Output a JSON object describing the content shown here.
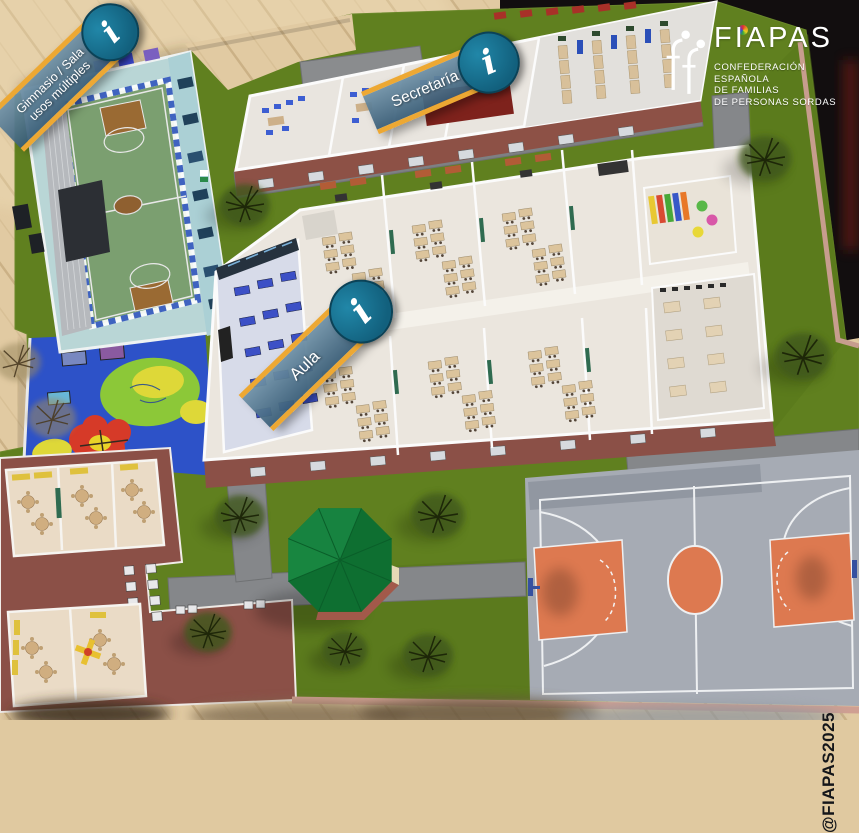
{
  "hotspots": [
    {
      "id": "gimnasio",
      "label_line1": "Gimnasio / Sala",
      "label_line2": "usos múltiples",
      "info_glyph": "i"
    },
    {
      "id": "secretaria",
      "label": "Secretaría",
      "info_glyph": "i"
    },
    {
      "id": "aula",
      "label": "Aula",
      "info_glyph": "i"
    }
  ],
  "logo": {
    "name": "FIAPAS",
    "tagline_line1": "CONFEDERACIÓN",
    "tagline_line2": "ESPAÑOLA",
    "tagline_line3": "DE FAMILIAS",
    "tagline_line4": "DE PERSONAS SORDAS"
  },
  "watermark": "@FIAPAS2025",
  "colors": {
    "banner_border": "#eda833",
    "banner_blue": "#4f7c9b",
    "info_teal": "#12607d",
    "grass": "#60801f",
    "wood_floor": "#e1caa2",
    "path_gray": "#85878a",
    "court_gray": "#a6abb4",
    "court_orange": "#dd7950",
    "playground_blue": "#2d52c8",
    "gym_wall": "#b5d4d6",
    "brick": "#8b5047",
    "gazebo_green": "#0e6f31",
    "dark_backdrop": "#120e0f"
  }
}
